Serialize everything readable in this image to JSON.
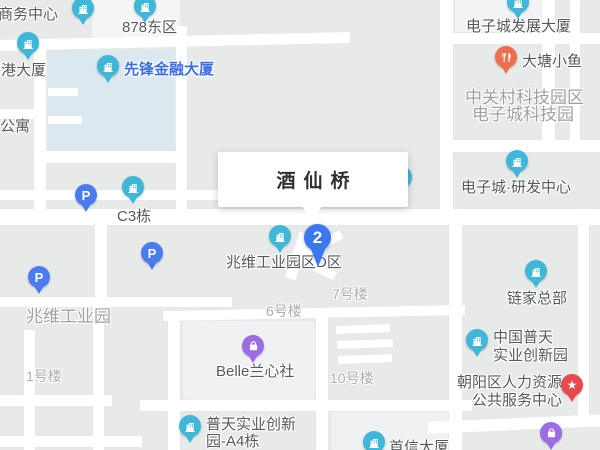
{
  "map": {
    "info_box": {
      "title": "酒仙桥"
    },
    "marker": {
      "label": "2",
      "x": 318,
      "y": 238,
      "color": "#3B78F0"
    },
    "colors": {
      "poi_teal": "#3FB7D8",
      "parking_blue": "#4A7CF0",
      "restaurant_orange": "#EE6F4E",
      "service_red": "#E8494E",
      "shop_purple": "#9D6CE3",
      "highlight_text": "#3C6FE3",
      "label_dark": "#57595C",
      "area_gray": "#9CA1A6",
      "water": "#DCE8F0"
    },
    "pois": [
      {
        "id": "biz-center-878",
        "icon": "building-icon",
        "color": "#3FB7D8",
        "cx": 83,
        "cy": 8,
        "lines": [
          {
            "text": "878商务中心",
            "x": -27,
            "y": 3
          }
        ]
      },
      {
        "id": "878-east-area",
        "icon": "building-icon",
        "color": "#3FB7D8",
        "cx": 145,
        "cy": 6,
        "lines": [
          {
            "text": "878东区",
            "x": 122,
            "y": 16
          }
        ]
      },
      {
        "id": "gang-tower",
        "icon": "building-icon",
        "color": "#3FB7D8",
        "cx": 28,
        "cy": 43,
        "lines": [
          {
            "text": "南港大厦",
            "x": -14,
            "y": 59
          }
        ]
      },
      {
        "id": "xianfeng-finance-tower",
        "icon": "building-icon",
        "color": "#3FB7D8",
        "cx": 108,
        "cy": 66,
        "highlight": true,
        "lines": [
          {
            "text": "先锋金融大厦",
            "x": 124,
            "y": 58
          }
        ]
      },
      {
        "id": "dianzicheng-development-tower",
        "icon": "building-icon",
        "color": "#3FB7D8",
        "cx": 518,
        "cy": 2,
        "lines": [
          {
            "text": "电子城发展大厦",
            "x": 466,
            "y": 15
          }
        ]
      },
      {
        "id": "datang-xiaoyu-restaurant",
        "icon": "restaurant-icon",
        "color": "#EE6F4E",
        "cx": 506,
        "cy": 57,
        "lines": [
          {
            "text": "大塘小鱼",
            "x": 522,
            "y": 50
          }
        ]
      },
      {
        "id": "dianzicheng-rd-center",
        "icon": "building-icon",
        "color": "#3FB7D8",
        "cx": 517,
        "cy": 161,
        "lines": [
          {
            "text": "电子城·研发中心",
            "x": 461,
            "y": 176
          }
        ]
      },
      {
        "id": "c3-building",
        "icon": "building-icon",
        "color": "#3FB7D8",
        "cx": 133,
        "cy": 187,
        "lines": [
          {
            "text": "C3栋",
            "x": 117,
            "y": 205
          }
        ]
      },
      {
        "id": "parking-1",
        "icon": "parking-icon",
        "color": "#4A7CF0",
        "cx": 86,
        "cy": 195,
        "lines": []
      },
      {
        "id": "parking-2",
        "icon": "parking-icon",
        "color": "#4A7CF0",
        "cx": 152,
        "cy": 253,
        "lines": []
      },
      {
        "id": "parking-3",
        "icon": "parking-icon",
        "color": "#4A7CF0",
        "cx": 39,
        "cy": 277,
        "lines": []
      },
      {
        "id": "zhaowei-industrial-d-area",
        "icon": "building-icon",
        "color": "#3FB7D8",
        "cx": 280,
        "cy": 236,
        "lines": [
          {
            "text": "兆维工业园区D区",
            "x": 226,
            "y": 251
          }
        ]
      },
      {
        "id": "lianjia-hq",
        "icon": "building-icon",
        "color": "#3FB7D8",
        "cx": 536,
        "cy": 271,
        "lines": [
          {
            "text": "链家总部",
            "x": 507,
            "y": 287
          }
        ]
      },
      {
        "id": "belle-lanxinshe",
        "icon": "bag-icon",
        "color": "#9D6CE3",
        "cx": 253,
        "cy": 346,
        "lines": [
          {
            "text": "Belle兰心社",
            "x": 216,
            "y": 360
          }
        ]
      },
      {
        "id": "china-putian-innovation-park",
        "icon": "building-icon",
        "color": "#3FB7D8",
        "cx": 477,
        "cy": 340,
        "lines": [
          {
            "text": "中国普天",
            "x": 493,
            "y": 326
          },
          {
            "text": "实业创新园",
            "x": 493,
            "y": 344
          }
        ]
      },
      {
        "id": "chaoyang-hr-service-center",
        "icon": "star-icon",
        "color": "#E8494E",
        "cx": 572,
        "cy": 385,
        "lines": [
          {
            "text": "朝阳区人力资源",
            "x": 457,
            "y": 371
          },
          {
            "text": "公共服务中心",
            "x": 472,
            "y": 389
          }
        ]
      },
      {
        "id": "putian-a4-building",
        "icon": "building-icon",
        "color": "#3FB7D8",
        "cx": 190,
        "cy": 426,
        "lines": [
          {
            "text": "普天实业创新",
            "x": 206,
            "y": 413
          },
          {
            "text": "园-A4栋",
            "x": 206,
            "y": 430
          }
        ]
      },
      {
        "id": "shouxin-tower",
        "icon": "building-icon",
        "color": "#3FB7D8",
        "cx": 374,
        "cy": 442,
        "lines": [
          {
            "text": "首信大厦",
            "x": 389,
            "y": 436
          }
        ]
      },
      {
        "id": "shop-poi-bottom-right",
        "icon": "bag-icon",
        "color": "#9D6CE3",
        "cx": 551,
        "cy": 433,
        "lines": []
      },
      {
        "id": "hidden-poi-behind-infobox",
        "icon": "building-icon",
        "color": "#3FB7D8",
        "cx": 401,
        "cy": 177,
        "behind": true,
        "lines": []
      }
    ],
    "area_labels": [
      {
        "id": "zhongguancun-science-park",
        "size": 17,
        "color": "#9CA1A6",
        "lines": [
          {
            "text": "中关村科技园区",
            "x": 465,
            "y": 83
          },
          {
            "text": "电子城科技园",
            "x": 472,
            "y": 100
          }
        ]
      },
      {
        "id": "zhaowei-industrial-park",
        "size": 17,
        "color": "#9CA1A6",
        "lines": [
          {
            "text": "兆维工业园",
            "x": 26,
            "y": 302
          }
        ]
      },
      {
        "id": "building-no7",
        "size": 14,
        "color": "#A9ADB0",
        "lines": [
          {
            "text": "7号楼",
            "x": 332,
            "y": 284
          }
        ]
      },
      {
        "id": "building-no6",
        "size": 14,
        "color": "#A9ADB0",
        "lines": [
          {
            "text": "6号楼",
            "x": 266,
            "y": 301
          }
        ]
      },
      {
        "id": "building-no10",
        "size": 14,
        "color": "#A9ADB0",
        "lines": [
          {
            "text": "10号楼",
            "x": 330,
            "y": 368
          }
        ]
      },
      {
        "id": "building-no1",
        "size": 14,
        "color": "#A9ADB0",
        "lines": [
          {
            "text": "1号楼",
            "x": 26,
            "y": 366
          }
        ]
      },
      {
        "id": "apartment-label",
        "size": 15,
        "color": "#57595C",
        "lines": [
          {
            "text": "公寓",
            "x": 0,
            "y": 115
          }
        ]
      }
    ]
  }
}
